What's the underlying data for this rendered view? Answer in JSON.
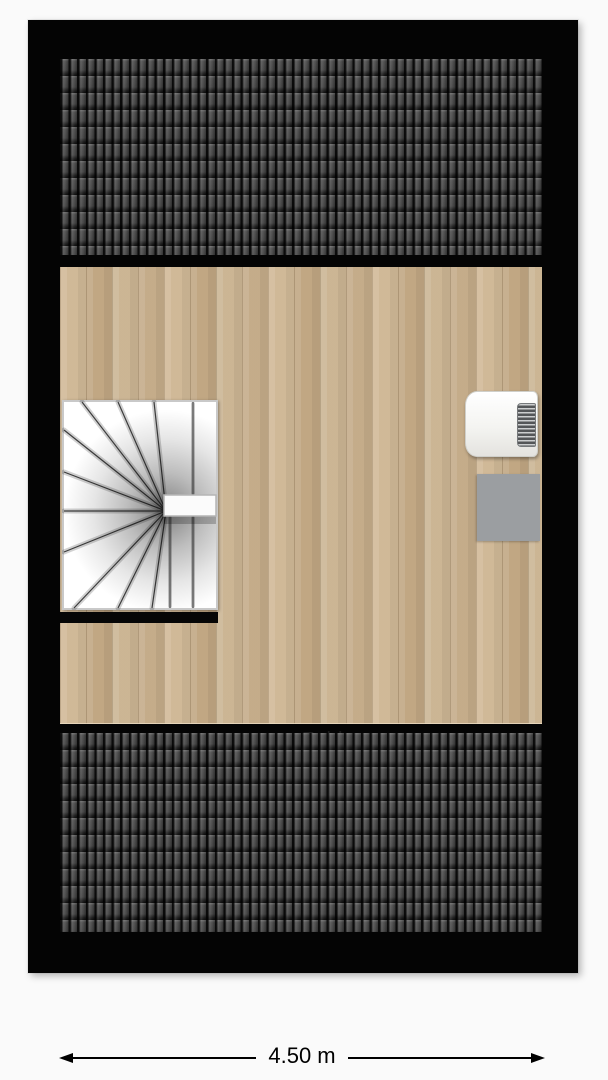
{
  "floorplan": {
    "room": {
      "label": "Zolder"
    },
    "dimension": {
      "width_label": "4.50 m"
    },
    "colors": {
      "wall": "#040404",
      "roof_tile_dark": "#0b0b0b",
      "roof_tile_light": "#4b4b4b",
      "wood_floor": "#c9b08c",
      "stair_tread": "#ffffff",
      "stair_border": "#c9c9c9",
      "appliance_body": "#f4f4f1",
      "appliance_vent": "#8f9294",
      "mat": "#9b9ea1",
      "dimension_line": "#000000",
      "page_background": "#fafafa"
    },
    "objects": {
      "staircase": "winder-staircase",
      "appliance": "wall-mounted-unit",
      "mat": "floor-mat"
    }
  }
}
